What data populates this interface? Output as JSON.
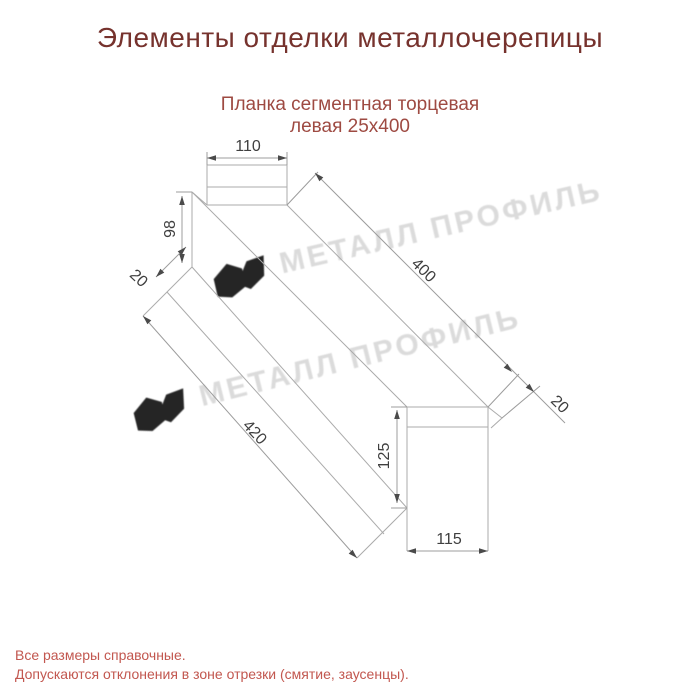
{
  "page": {
    "title": "Элементы отделки металлочерепицы",
    "subtitle_line1": "Планка сегментная торцевая",
    "subtitle_line2": "левая 25х400",
    "footer_line1": "Все размеры справочные.",
    "footer_line2": "Допускаются отклонения в зоне отрезки (смятие, заусенцы)."
  },
  "drawing": {
    "type": "technical-dimension-drawing",
    "dimensions": {
      "top_width": "110",
      "left_height": "98",
      "left_flange": "20",
      "length_top": "400",
      "length_bottom": "420",
      "right_flange": "20",
      "tab_height": "125",
      "tab_width": "115"
    }
  },
  "watermark": {
    "text": "МЕТАЛЛ ПРОФИЛЬ"
  },
  "colors": {
    "title": "#76322d",
    "subtitle": "#9e4a42",
    "footer": "#c2574f",
    "line": "#ababab",
    "dim_text": "#3f3f3f",
    "watermark": "#d5d5d5"
  }
}
